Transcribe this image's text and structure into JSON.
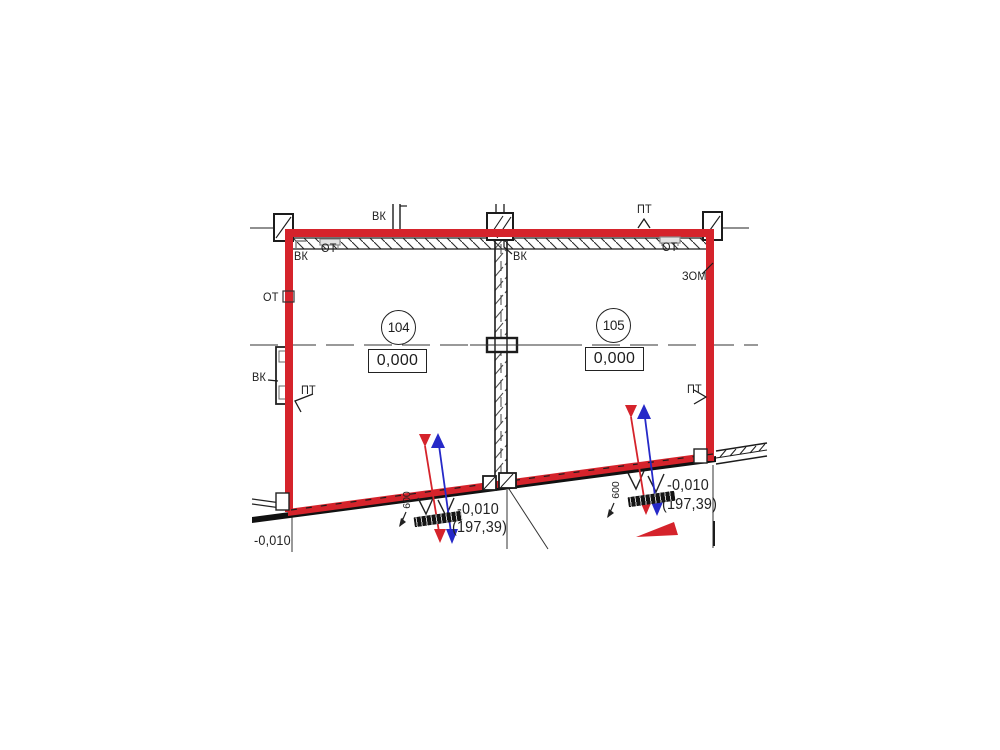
{
  "drawing_type": "architectural floor plan fragment",
  "labels": {
    "vk": "ВК",
    "ot": "ОТ",
    "pt": "ПТ",
    "zom": "ЗОМ"
  },
  "rooms": [
    {
      "number": "104",
      "elevation": "0,000"
    },
    {
      "number": "105",
      "elevation": "0,000"
    }
  ],
  "marks": [
    {
      "relative": "-0,010",
      "absolute": "(197,39)",
      "offset": "600"
    },
    {
      "relative": "-0,010",
      "absolute": "(197,39)",
      "offset": "600"
    }
  ],
  "bottom_left": {
    "relative": "-0,010"
  },
  "colors": {
    "wall_red": "#d5232b",
    "marker_blue": "#2629c8",
    "line_black": "#1c1c1c",
    "bracket_gray": "#8a8a8a"
  }
}
